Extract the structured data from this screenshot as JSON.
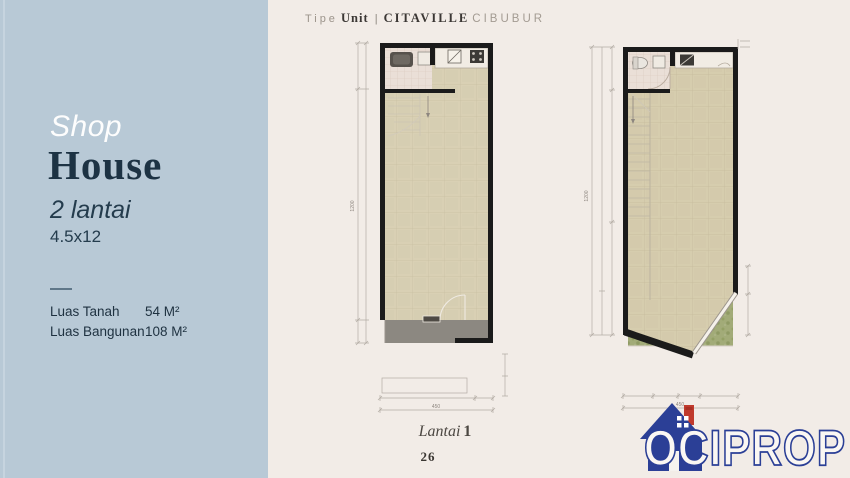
{
  "header": {
    "tipe": "Tipe",
    "unit": "Unit",
    "separator": "|",
    "brand": "CITAVILLE",
    "location": "CIBUBUR"
  },
  "sidebar": {
    "title_line1": "Shop",
    "title_line2": "House",
    "floors": "2 lantai",
    "size": "4.5x12",
    "specs": [
      {
        "label": "Luas Tanah",
        "value": "54 M²"
      },
      {
        "label": "Luas Bangunan",
        "value": "108 M²"
      }
    ]
  },
  "caption": {
    "label": "Lantai",
    "number": "1"
  },
  "page_number": "26",
  "logo": {
    "text": "OCIPROP"
  },
  "dims": {
    "plan1_total_width": "450",
    "plan1_total_height": "1200",
    "plan2_total_width": "450",
    "plan2_total_height": "1200"
  },
  "colors": {
    "sidebar_bg": "#b8c9d6",
    "main_bg": "#f2ece7",
    "accent_dark": "#1d3344",
    "wall": "#1b1b1b",
    "floor_tile": "#d9d0b4",
    "logo_blue": "#2b3f96",
    "logo_red": "#c03a2d",
    "garden_green": "#a2ab78"
  }
}
